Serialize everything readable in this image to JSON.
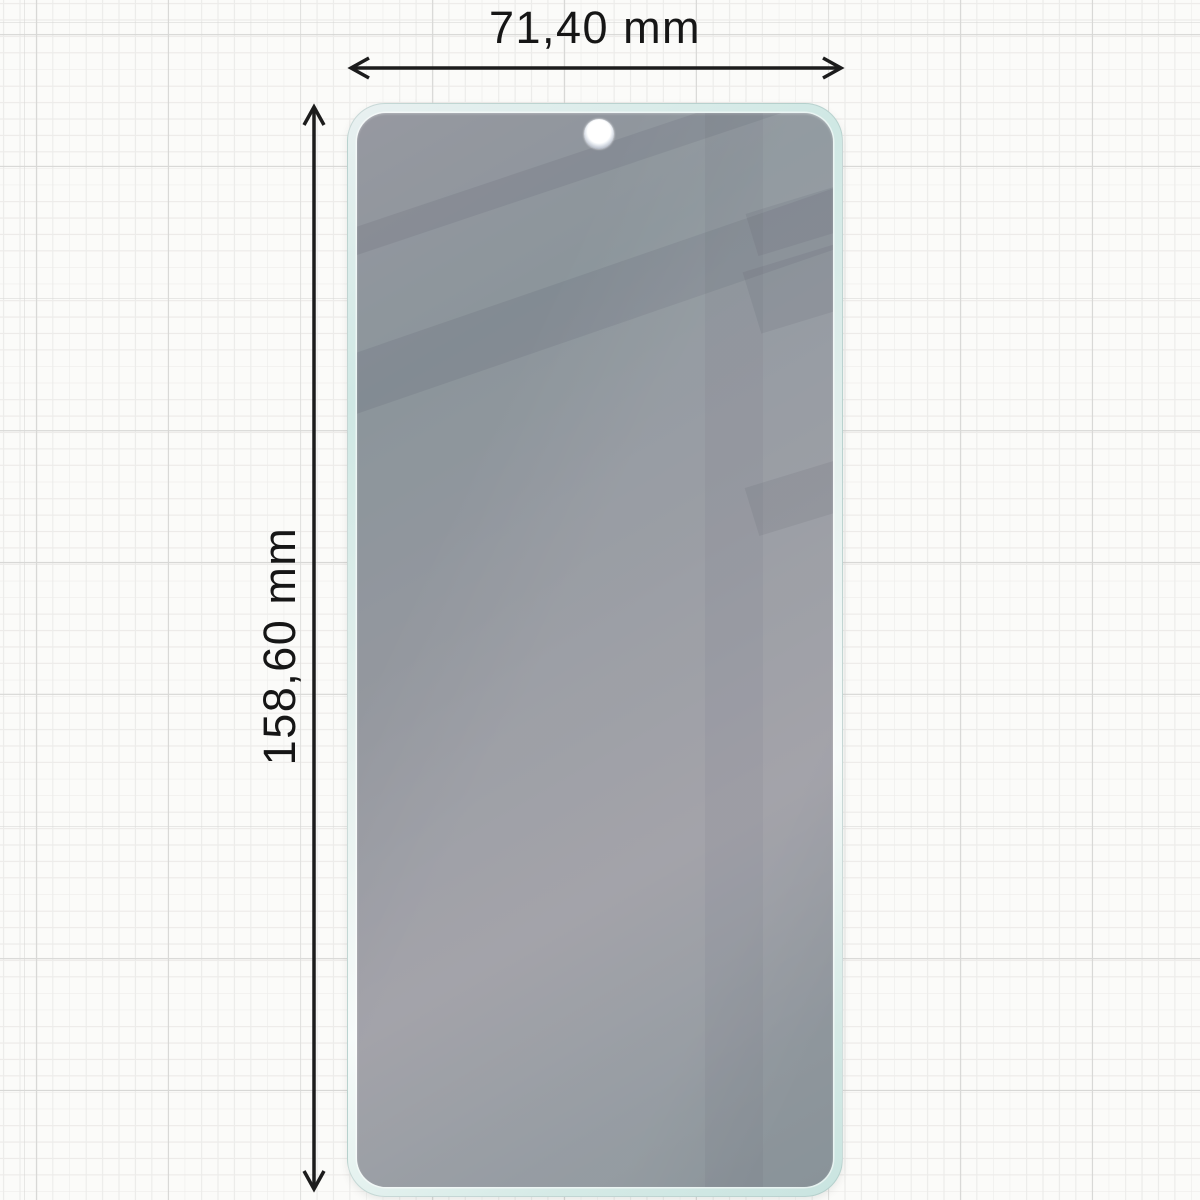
{
  "diagram": {
    "type": "screen-protector-dimension-diagram",
    "width_label": "71,40 mm",
    "height_label": "158,60 mm",
    "width_value": "71,40",
    "height_value": "158,60",
    "unit": "mm"
  },
  "icons": {
    "camera_hole": "punch-hole-camera-cutout",
    "width_arrow": "double-headed-horizontal-arrow",
    "height_arrow": "double-headed-vertical-arrow"
  },
  "colors": {
    "paper_background": "#fbfbf9",
    "grid_minor": "#ececea",
    "grid_major": "#d8d8d6",
    "protector_rim_mint": "#cfe8e4",
    "protector_glass_gray": "#a09ea6",
    "reflection_dark": "rgba(58,54,74,0.10)",
    "arrow": "#1c1c1c",
    "label_text": "#161616"
  }
}
